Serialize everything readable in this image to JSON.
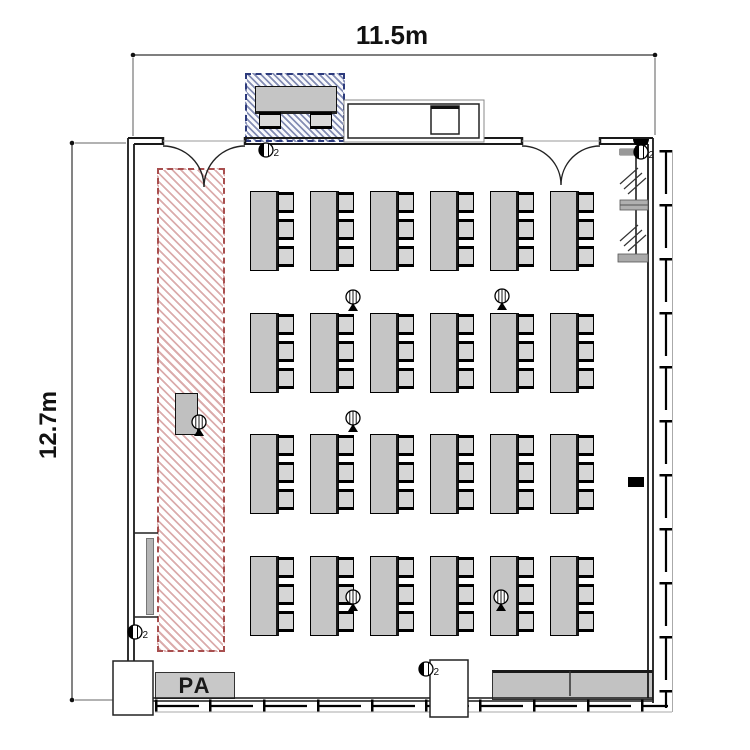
{
  "dimensions": {
    "width_label": "11.5m",
    "height_label": "12.7m"
  },
  "labels": {
    "pa": "PA"
  },
  "areas": {
    "stage": {
      "name": "speaker-stage-zone",
      "hatch_color": "#bd6868",
      "border": "dashed-red"
    },
    "reception": {
      "name": "reception-desk-zone",
      "hatch_color": "#42508c",
      "border": "dashed-blue",
      "chairs": 2
    }
  },
  "seating": {
    "rows": 4,
    "cols": 6,
    "chairs_per_table": 3,
    "col_x": [
      250,
      310,
      370,
      430,
      490,
      550
    ],
    "row_y": [
      191,
      313,
      434,
      556
    ],
    "chair_offsets": [
      1,
      28,
      55
    ]
  },
  "equipment": {
    "floor_mics": [
      {
        "x": 353,
        "y": 297
      },
      {
        "x": 502,
        "y": 296
      },
      {
        "x": 353,
        "y": 418
      },
      {
        "x": 353,
        "y": 597
      },
      {
        "x": 501,
        "y": 597
      },
      {
        "x": 199,
        "y": 422
      }
    ],
    "wall_jacks": [
      {
        "x": 266,
        "y": 150,
        "label": "2"
      },
      {
        "x": 135,
        "y": 632,
        "label": "2"
      },
      {
        "x": 426,
        "y": 669,
        "label": "2"
      },
      {
        "x": 641,
        "y": 152,
        "label": "2"
      }
    ],
    "speaker": {
      "x": 641,
      "y": 139
    },
    "outlet": {
      "x": 628,
      "y": 477
    }
  },
  "colors": {
    "wall": "#1a1a1a",
    "table_fill": "#c5c5c5",
    "chair_fill": "#d6d6d6"
  }
}
